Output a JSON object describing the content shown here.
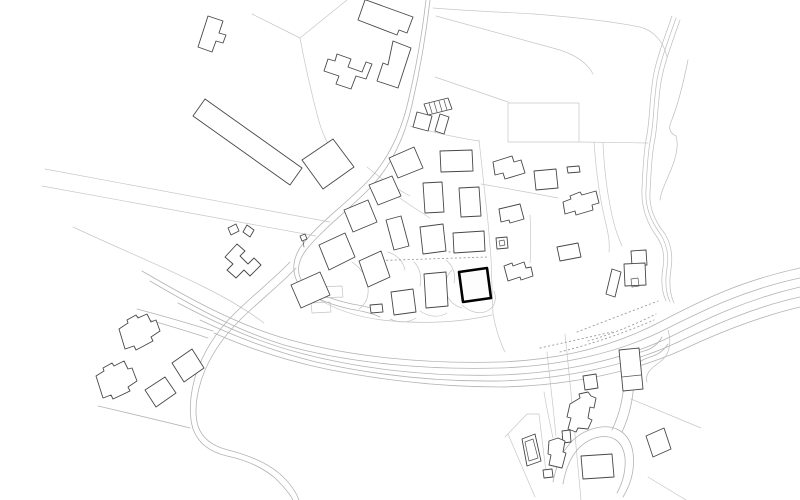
{
  "meta": {
    "title": "architectural site plan",
    "type": "site-plan",
    "canvas": {
      "width": 800,
      "height": 500,
      "background": "#ffffff"
    }
  },
  "styles": {
    "building": {
      "stroke": "#474747",
      "width": 0.9,
      "fill": "#ffffff"
    },
    "highlight": {
      "stroke": "#000000",
      "width": 2.6,
      "fill": "#fdfdfd"
    },
    "detail": {
      "stroke": "#555555",
      "width": 0.7,
      "fill": "none"
    },
    "road": {
      "stroke": "#b3b3b3",
      "width": 0.8,
      "fill": "none"
    },
    "boundary": {
      "stroke": "#c7c7c7",
      "width": 0.7,
      "fill": "none"
    },
    "path": {
      "stroke": "#c3c3c3",
      "width": 0.7,
      "fill": "none"
    },
    "creek": {
      "stroke": "#bdbdbd",
      "width": 0.7,
      "fill": "none"
    },
    "dotted": {
      "stroke": "#9a9a9a",
      "width": 0.9,
      "fill": "none",
      "dash": "1.3 3"
    }
  },
  "layers": [
    {
      "name": "parcel-boundaries",
      "item": "parcel-boundary-line",
      "style": "boundary",
      "paths": [
        "M45,169 L330,222",
        "M42,186 L316,236",
        "M252,14 L300,38",
        "M347,0 L300,38",
        "M300,38 C306,70 312,95 318,118 C322,133 327,143 332,150",
        "M367,167 C380,178 395,188 410,196",
        "M433,8 C470,11 500,12 534,14 C572,17 610,21 640,27 C655,31 664,43 667,57",
        "M436,16 C480,28 525,40 560,50 C578,56 588,64 593,74",
        "M435,77 L508,102",
        "M508,103 L579,103 L579,142 L508,142 Z",
        "M579,142 L648,143",
        "M603,143 C604,165 606,185 610,205 C613,222 616,232 622,246",
        "M594,142 C596,170 599,195 605,220 C608,232 610,242 609,252",
        "M410,126 C436,133 458,138 479,141",
        "M479,140 C482,168 485,196 488,222 L491,258",
        "M481,184 C510,189 532,193 558,198",
        "M491,258 L493,314",
        "M493,314 C496,330 500,342 505,352",
        "M530,215 C531,235 531,250 530,263",
        "M397,196 C408,204 419,211 430,218",
        "M73,227 C120,249 162,266 204,287 C228,299 247,310 264,323",
        "M565,334 C571,390 576,445 581,500",
        "M547,352 C551,390 554,414 556,436",
        "M505,437 L527,414 L539,414 L546,472",
        "M508,434 L535,497",
        "M631,399 L701,428",
        "M648,477 L686,500",
        "M544,392 C547,410 550,424 553,438"
      ]
    },
    {
      "name": "roads",
      "item": "road-line",
      "style": "road",
      "paths": [
        "M430,0 C426,35 420,70 412,105 C404,140 390,168 368,190 C346,212 322,230 306,250 C298,261 296,272 302,281 C310,292 330,299 352,304 C364,306 374,308 382,312",
        "M426,0 C422,35 416,68 408,102 C400,136 386,163 365,184 C343,206 318,224 302,245 C293,257 291,271 298,283 C307,296 328,304 350,309 C362,311 372,313 380,317",
        "M296,268 C280,285 258,302 240,320 C224,336 210,355 202,378 C196,396 194,412 198,426 C202,438 212,446 228,450 C248,455 266,462 280,474 C290,483 296,492 299,500",
        "M290,262 C274,279 252,296 234,314 C218,330 204,350 196,374 C190,394 188,412 193,429 C198,443 210,452 227,456 C246,460 262,467 275,478 C284,487 290,494 293,500",
        "M142,271 C190,299 232,322 280,337 C350,358 430,364 500,362 C560,360 614,346 660,322 C700,301 740,281 800,268",
        "M150,281 C196,308 236,330 284,345 C352,364 430,370 500,368 C560,366 618,353 664,330 C704,310 744,290 800,278",
        "M178,303 C220,325 258,342 300,353 C360,369 430,377 500,375 C562,373 622,360 670,337 C708,318 748,299 800,287",
        "M200,320 C240,339 276,352 316,362 C370,374 432,382 500,381 C564,379 626,366 676,343 C714,325 754,307 800,297",
        "M214,333 C252,350 288,361 326,369 C376,379 434,387 500,387 C566,386 630,373 682,350 C718,333 758,317 800,307",
        "M553,482 C558,456 570,436 592,429 C614,422 630,432 633,453 C635,469 631,484 623,497",
        "M563,484 C567,461 577,444 595,438 C612,433 623,441 625,458 C626,471 623,482 617,493",
        "M622,432 C630,415 634,395 634,375 C634,365 640,360 650,357 C658,355 664,350 668,344",
        "M612,430 C620,413 624,395 624,377 C624,362 632,354 644,351 C652,349 658,344 662,337",
        "M98,406 C128,413 158,420 190,428",
        "M137,309 C163,316 188,323 213,331",
        "M135,316 C160,323 184,330 208,338"
      ]
    },
    {
      "name": "garden-paths",
      "item": "path-line",
      "style": "path",
      "paths": [
        "M352,262 C361,268 367,277 368,287 C369,297 366,304 359,309",
        "M388,252 C397,255 403,261 405,270",
        "M414,262 C420,268 422,277 420,286",
        "M446,260 C453,266 456,274 454,283",
        "M462,305 C471,313 481,315 489,310 C495,306 497,298 494,291",
        "M452,270 C446,276 444,284 446,292 C448,300 454,306 462,308",
        "M420,311 C429,317 439,318 447,313",
        "M390,319 C399,323 408,323 416,318",
        "M320,300 C342,313 366,319 392,321 C428,324 462,322 492,315",
        "M317,287 L342,286 L343,297 L318,298 Z",
        "M311,303 L330,302 L331,312 L312,313 Z"
      ]
    },
    {
      "name": "creek",
      "item": "creek-line",
      "style": "creek",
      "paths": [
        "M672,16 C663,42 656,60 653,78 C649,104 650,122 646,140 C643,158 643,172 642,188 C641,206 646,222 657,237 C663,246 665,256 663,267 C661,279 661,290 666,301",
        "M676,18 C667,44 660,62 657,80 C653,106 654,124 650,142 C647,160 647,174 646,190 C645,206 650,220 661,235 C667,245 669,256 667,268 C665,280 665,291 670,302",
        "M680,20 C671,46 664,64 661,82 C657,108 658,126 654,144 C651,162 651,176 650,192 C649,207 654,220 665,234 C671,244 673,256 671,269 C669,281 669,292 674,303",
        "M688,60 C683,85 678,105 671,122 C668,128 670,133 676,136 C679,145 676,158 670,172 C665,184 661,192 660,200",
        "M668,330 C672,344 669,355 660,362 C650,369 645,374 647,382"
      ]
    },
    {
      "name": "dotted-marks",
      "item": "dotted-line",
      "style": "dotted",
      "paths": [
        "M365,261 L488,257",
        "M449,252 L484,250",
        "M540,348 L612,332",
        "M560,352 C592,344 624,333 654,320",
        "M577,332 L658,301",
        "M588,341 C612,334 634,325 656,314"
      ]
    },
    {
      "name": "buildings",
      "item": "building-footprint",
      "style": "building",
      "paths": [
        "M208,16 L223,21 L219,33 L226,35 L223,43 L216,41 L212,52 L198,47 Z",
        "M366,0 L413,17 L407,33 L399,30 L397,35 L358,20 L365,0 Z",
        "M393,41 L411,48 L398,88 L377,81 L383,63 L388,65 Z",
        "M337,54 L351,59 L348,67 L362,72 L366,62 L372,64 L366,79 L356,76 L351,89 L336,84 L339,76 L324,71 L328,59 L335,61 Z",
        "M424,104 L448,98 L452,109 L428,115 Z",
        "M417,112 L432,116 L428,131 L413,127 Z",
        "M440,114 L449,117 L444,134 L435,131 Z",
        "M389,158 L414,147 L423,168 L398,178 Z",
        "M440,151 L472,150 L473,171 L441,172 Z",
        "M493,162 L512,156 L514,162 L521,160 L525,173 L505,179 L503,173 L495,175 Z",
        "M534,171 L556,169 L558,188 L536,190 Z",
        "M423,183 L442,182 L444,212 L425,213 Z",
        "M459,188 L479,187 L481,216 L461,217 Z",
        "M499,209 L520,204 L524,219 L510,223 L509,220 L501,222 Z",
        "M386,220 L401,216 L409,246 L394,250 Z",
        "M420,227 L443,224 L446,251 L423,254 Z",
        "M453,233 L484,231 L485,251 L454,253 Z",
        "M496,238 L507,237 L508,248 L497,249 Z",
        "M344,210 L368,200 L377,222 L353,232 Z",
        "M319,245 L345,233 L355,257 L329,270 Z",
        "M359,261 L381,251 L390,277 L368,287 Z",
        "M291,285 L320,272 L330,295 L301,308 Z",
        "M391,292 L413,289 L416,312 L394,315 Z",
        "M424,274 L446,272 L448,306 L426,308 Z",
        "M370,305 L382,304 L383,312 L371,313 Z",
        "M504,266 L512,263 L513,266 L524,262 L526,268 L531,267 L533,276 L521,280 L520,277 L508,281 Z",
        "M369,185 L392,176 L401,196 L378,205 Z",
        "M205,99 L302,168 L290,185 L193,116 Z",
        "M302,160 L333,139 L354,167 L323,189 Z",
        "M228,228 L236,224 L239,231 L231,235 Z",
        "M247,225 L254,230 L250,237 L243,232 Z",
        "M237,244 L245,251 L240,256 L248,264 L254,258 L261,265 L250,276 L244,270 L236,278 L227,270 L233,264 L225,257 Z",
        "M96,376 L104,371 L103,368 L112,363 L114,366 L124,361 L128,369 L132,368 L137,381 L128,387 L130,391 L113,399 L111,395 L103,398 Z",
        "M119,329 L128,323 L127,320 L136,315 L138,318 L147,314 L151,322 L156,320 L160,331 L151,337 L153,341 L136,350 L134,346 L125,349 Z",
        "M172,363 L192,349 L204,368 L184,382 Z",
        "M145,390 L165,377 L176,393 L156,407 Z",
        "M563,202 L571,199 L570,196 L580,192 L582,195 L596,191 L599,203 L592,205 L593,210 L576,215 L575,211 L565,214 Z",
        "M557,247 L578,243 L581,257 L560,261 Z",
        "M567,167 L579,166 L580,172 L568,173 Z",
        "M631,251 L646,250 L647,265 L632,266 Z",
        "M624,264 L645,263 L646,285 L625,286 Z",
        "M612,269 L621,272 L615,297 L606,294 Z",
        "M619,350 L639,348 L643,389 L623,391 Z",
        "M583,376 L596,374 L598,388 L585,390 Z",
        "M570,404 L580,398 L579,394 L588,392 L591,396 L596,398 L594,408 L590,407 L588,418 L592,420 L588,429 L578,428 L576,432 L568,429 L571,418 L567,417 Z",
        "M562,431 L570,430 L571,442 L563,443 Z",
        "M549,441 L558,438 L565,441 L563,452 L566,453 L562,468 L549,465 L551,455 L548,454 Z",
        "M543,470 L552,469 L553,477 L544,478 Z",
        "M581,456 L612,454 L614,477 L583,479 Z",
        "M646,436 L664,428 L671,449 L653,457 Z",
        "M522,439 L535,434 L541,461 L527,466 Z",
        "M300,236 L305,234 L307,239 L302,241 Z"
      ]
    },
    {
      "name": "building-details",
      "item": "building-detail-line",
      "style": "detail",
      "paths": [
        "M429,103 L432,113",
        "M434,102 L437,112",
        "M439,101 L442,111",
        "M444,100 L447,110",
        "M499,241 L504,240 L505,245 L500,246 Z",
        "M631,279 L638,278 L639,286 L632,287 Z",
        "M622,377 L641,375",
        "M525,442 L533,439 L538,458 L529,461 Z",
        "M303,241 L304,247"
      ]
    },
    {
      "name": "highlight",
      "item": "highlighted-building",
      "style": "highlight",
      "paths": [
        "M459,272 L487,268 L491,298 L463,302 Z"
      ]
    }
  ]
}
